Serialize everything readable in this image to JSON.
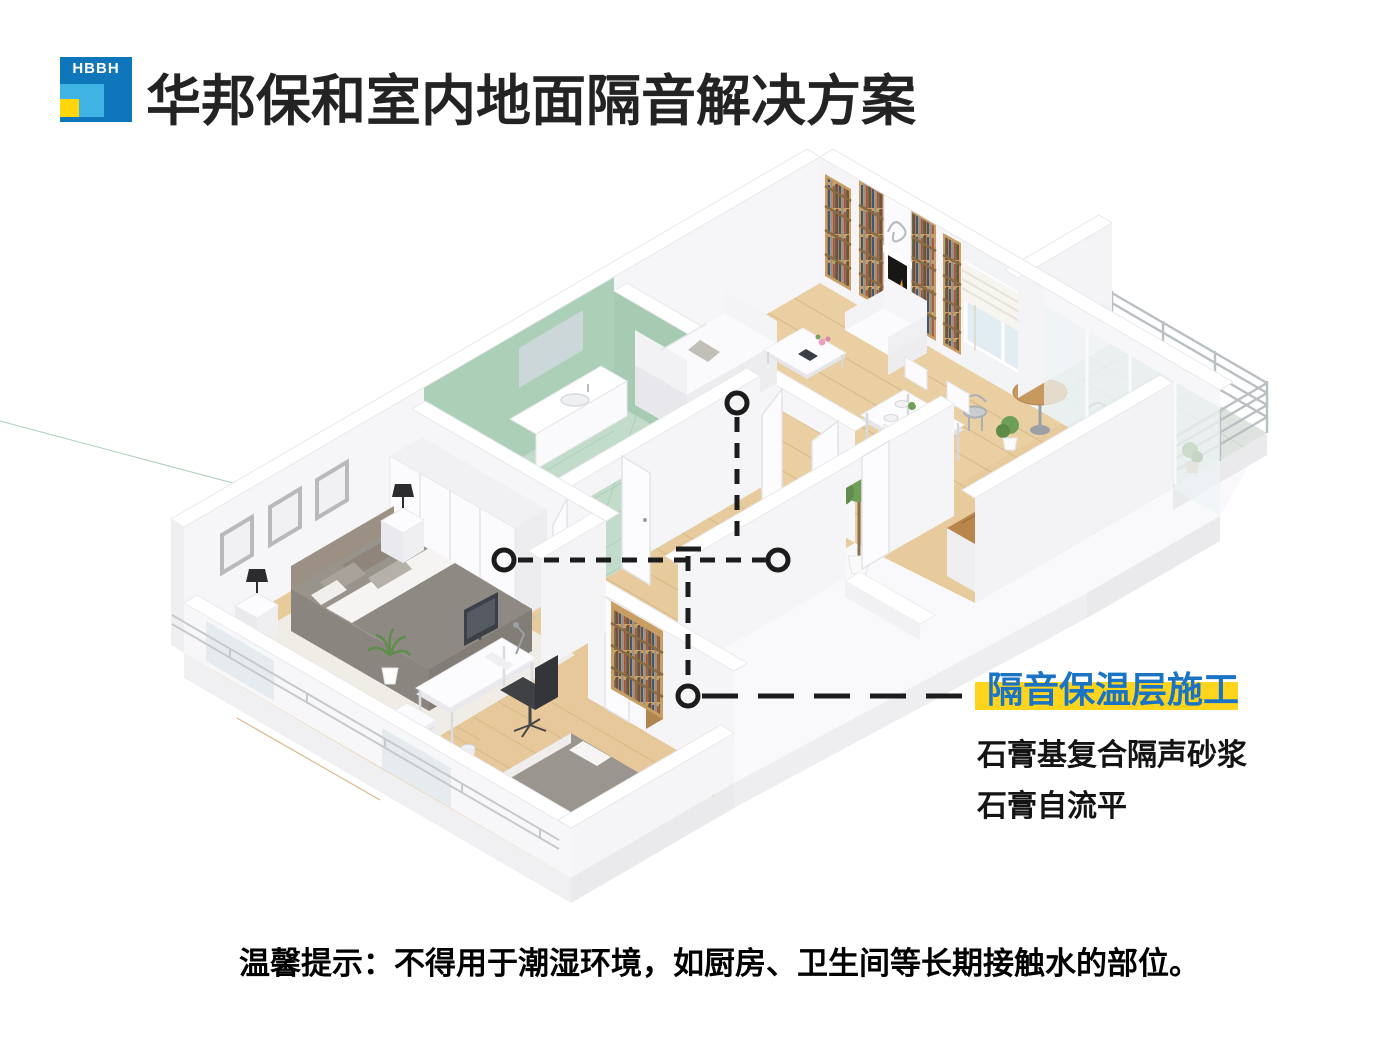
{
  "header": {
    "logo_text": "HBBH",
    "title": "华邦保和室内地面隔音解决方案"
  },
  "callout": {
    "label": "隔音保温层施工",
    "items": [
      "石膏基复合隔声砂浆",
      "石膏自流平"
    ],
    "label_color": "#1b74c3",
    "highlight_color": "#ffd41c"
  },
  "footer": {
    "tip": "温馨提示：不得用于潮湿环境，如厨房、卫生间等长期接触水的部位。"
  },
  "brand_colors": {
    "logo_blue": "#0f76bb",
    "logo_light_blue": "#3fb3e3",
    "logo_yellow": "#ffd60b",
    "title_color": "#232323",
    "leader_line_color": "#1c1c1c"
  },
  "floor_plan": {
    "kind": "isometric apartment cutaway illustration",
    "annotation_marker": "dashed black leader lines with circle endpoints pointing to the floor layer"
  }
}
